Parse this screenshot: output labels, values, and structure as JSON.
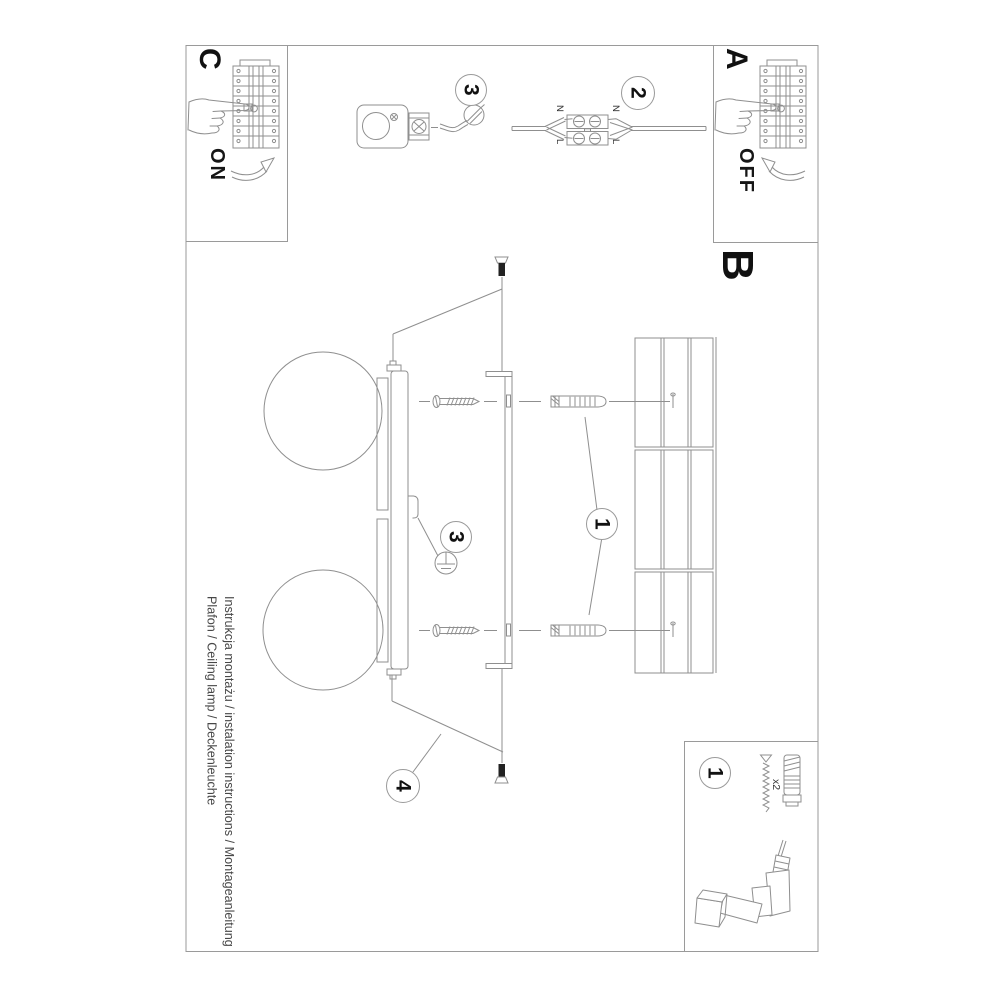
{
  "document": {
    "footer": {
      "line1": "Instrukcja montażu / instalation instructions / Montageanleitung",
      "line2": "Plafon / Ceiling lamp / Deckenleuchte"
    }
  },
  "steps": {
    "a": {
      "label": "A",
      "switch": "OFF"
    },
    "b": {
      "label": "B"
    },
    "c": {
      "label": "C",
      "switch": "ON"
    }
  },
  "callouts": {
    "one": "1",
    "two": "2",
    "three": "3",
    "four": "4"
  },
  "wiring": {
    "left_top": "N",
    "left_bottom": "L",
    "right_top": "N",
    "right_bottom": "L"
  },
  "toolbox": {
    "callout": "1",
    "anchor_qty": "x2"
  },
  "icons": {
    "flat_screwdriver": "flathead-screwdriver-icon",
    "pointing_hand": "pointing-hand-icon",
    "curved_arrow": "curved-arrow-icon",
    "drill": "power-drill-illustration"
  },
  "colors": {
    "line": "#8f8f8f",
    "frame": "#9a9a9a",
    "ink": "#1a1a1a",
    "text": "#474747",
    "background": "#ffffff"
  }
}
